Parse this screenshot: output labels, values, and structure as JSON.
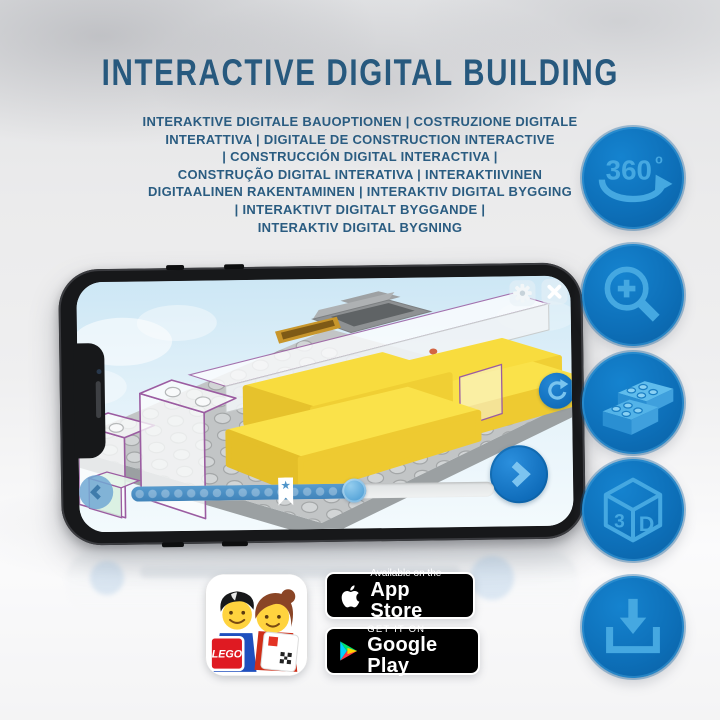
{
  "header": {
    "title": "INTERACTIVE DIGITAL BUILDING",
    "text_color": "#27597e",
    "subtitle_lines": [
      "INTERAKTIVE DIGITALE BAUOPTIONEN | COSTRUZIONE DIGITALE",
      "INTERATTIVA | DIGITALE DE CONSTRUCTION INTERACTIVE",
      "| CONSTRUCCIÓN DIGITAL INTERACTIVA |",
      "CONSTRUÇÃO DIGITAL INTERATIVA | INTERAKTIIVINEN",
      "DIGITAALINEN RAKENTAMINEN | INTERAKTIV DIGITAL BYGGING",
      "| INTERAKTIVT DIGITALT BYGGANDE |",
      "INTERAKTIV DIGITAL BYGNING"
    ]
  },
  "feature_icons": {
    "circle_color": "#0d6fb8",
    "glyph_color": "#45a8e1",
    "items": [
      {
        "name": "rotation-360-icon",
        "label": "360",
        "degree_symbol": "o"
      },
      {
        "name": "zoom-in-icon"
      },
      {
        "name": "brick-building-options-icon"
      },
      {
        "name": "cube-3d-icon",
        "label_left": "3",
        "label_right": "D"
      },
      {
        "name": "download-icon"
      }
    ]
  },
  "phone": {
    "screen": {
      "background_color": "#d9edf7",
      "highlight_brick_color": "#f8dc3e",
      "controls": [
        "settings-gear",
        "close",
        "rotate-model",
        "previous-step",
        "next-step",
        "build-progress-slider"
      ]
    }
  },
  "footer": {
    "lego_app_icon": {
      "logo_text": "LEGO"
    },
    "app_store_badge": {
      "top_line": "Available on the",
      "bottom_line": "App Store"
    },
    "google_play_badge": {
      "top_line": "GET IT ON",
      "bottom_line": "Google Play"
    }
  }
}
